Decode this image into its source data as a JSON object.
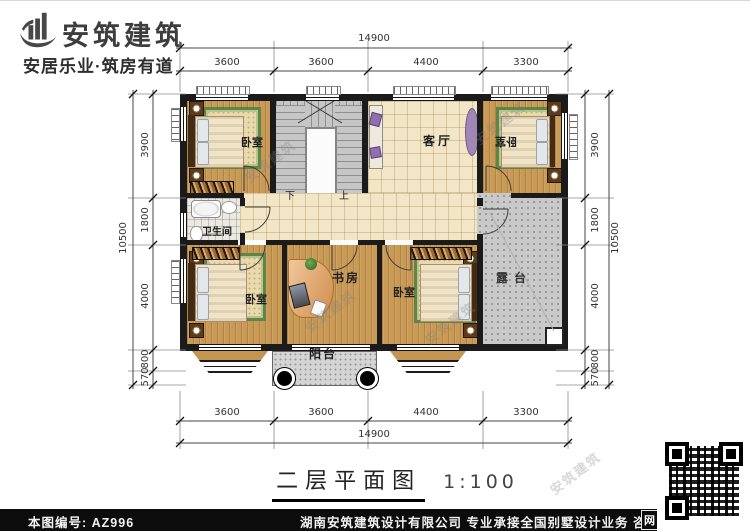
{
  "brand": {
    "logo_text": "安筑建筑",
    "tagline": "安居乐业·筑房有道"
  },
  "plan": {
    "rooms": {
      "bedroom_tl": "卧室",
      "bedroom_tr": "卧室",
      "bedroom_bl": "卧室",
      "bedroom_br": "卧室",
      "living_room": "客厅",
      "bathroom": "卫生间",
      "study": "书房",
      "balcony": "阳台",
      "terrace": "露台",
      "stair_down": "下",
      "stair_up": "上"
    },
    "dimensions": {
      "top": {
        "overall": "14900",
        "segments": [
          "3600",
          "3600",
          "4400",
          "3300"
        ]
      },
      "bottom": {
        "overall": "14900",
        "segments": [
          "3600",
          "3600",
          "4400",
          "3300"
        ]
      },
      "left": {
        "overall": "10500",
        "segments": [
          "3900",
          "1800",
          "4000",
          "800",
          "570"
        ]
      },
      "right": {
        "overall": "10500",
        "segments": [
          "3900",
          "1800",
          "4000",
          "800",
          "570"
        ]
      }
    }
  },
  "title": {
    "text": "二层平面图",
    "scale": "1:100"
  },
  "watermark": "安筑建筑",
  "footer": {
    "code": "本图编号: AZ996",
    "info": "湖南安筑建筑设计有限公司  专业承接全国别墅设计业务  咨询电话: 400-8070-511",
    "web": "网"
  }
}
